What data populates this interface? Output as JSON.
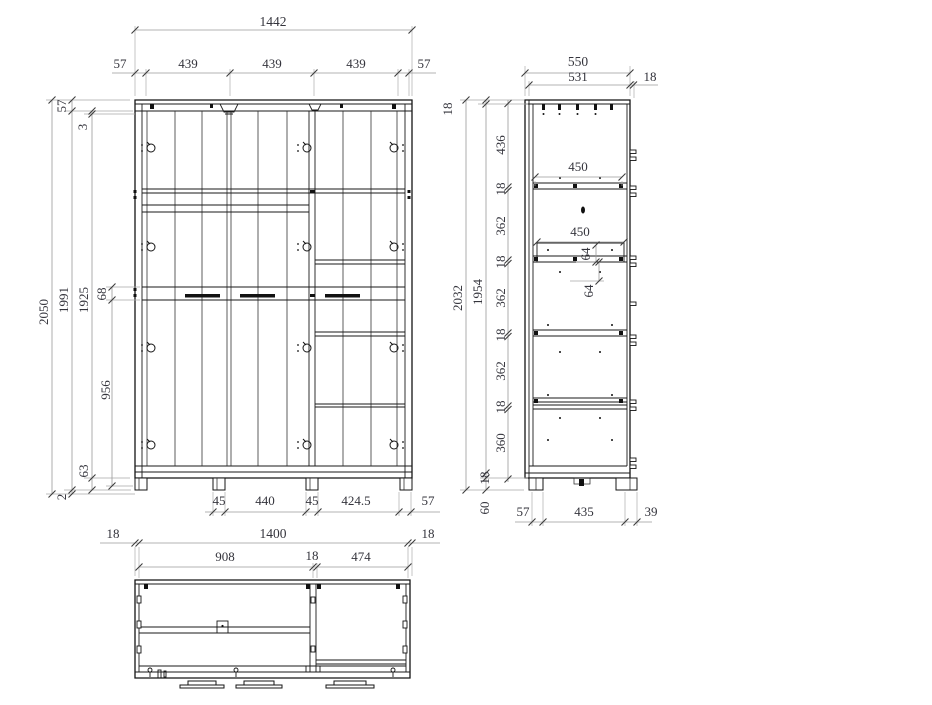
{
  "front_view": {
    "total_width": "1442",
    "top_chain": [
      "57",
      "439",
      "439",
      "439",
      "57"
    ],
    "height_overall": "2050",
    "height_body": "1991",
    "height_interior": "1925",
    "top_rail": "57",
    "top_gap": "3",
    "handle_rail": "68",
    "lower_section": "956",
    "bottom_rail": "63",
    "base_gap": "2",
    "bottom_chain": [
      "45",
      "440",
      "45",
      "424.5",
      "57"
    ]
  },
  "side_view": {
    "depth_total": "550",
    "depth_inner": "531",
    "front_edge": "18",
    "top_panel": "18",
    "height_overall": "2032",
    "height_inner": "1954",
    "section_chain": [
      "436",
      "18",
      "362",
      "18",
      "362",
      "18",
      "362",
      "18",
      "360"
    ],
    "bottom_panel": "18",
    "plinth_height": "60",
    "shelf_depth_upper": "450",
    "shelf_depth_lower": "450",
    "offset_upper": "64",
    "offset_lower": "64",
    "bottom_chain": [
      "57",
      "435",
      "39"
    ]
  },
  "plan_view": {
    "width_chain": [
      "18",
      "1400",
      "18"
    ],
    "inner_chain": [
      "908",
      "18",
      "474"
    ]
  },
  "colors": {
    "line": "#141414",
    "dimension_line": "#9a9a9a",
    "text": "#34343c",
    "background": "#ffffff"
  }
}
